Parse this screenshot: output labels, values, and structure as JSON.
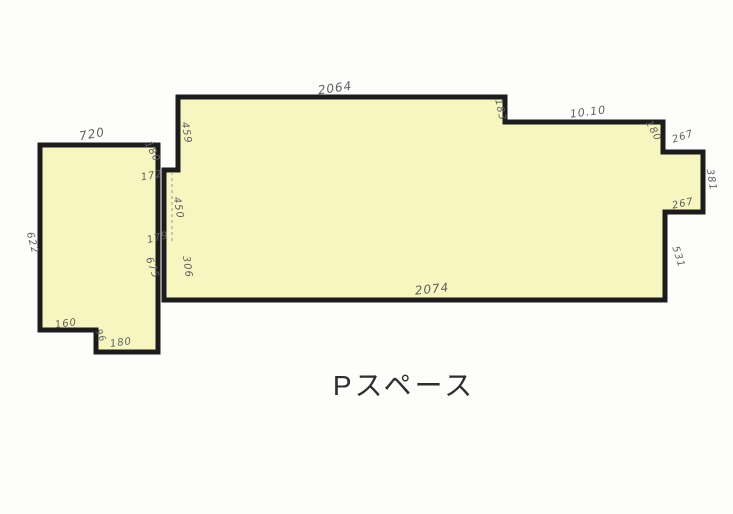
{
  "plan": {
    "title": "Pスペース",
    "fill_color": "#f7f6c1",
    "outline_color": "#1c1c1c",
    "label_color": "#5f5f5f",
    "dimension_labels": [
      {
        "text": "2064",
        "x": 335,
        "y": 88,
        "rot": -8,
        "size": 12
      },
      {
        "text": "183",
        "x": 500,
        "y": 110,
        "rot": 78,
        "size": 10
      },
      {
        "text": "10.10",
        "x": 588,
        "y": 112,
        "rot": -7,
        "size": 11
      },
      {
        "text": "180",
        "x": 653,
        "y": 131,
        "rot": 62,
        "size": 10
      },
      {
        "text": "267",
        "x": 683,
        "y": 137,
        "rot": -18,
        "size": 10
      },
      {
        "text": "381",
        "x": 711,
        "y": 180,
        "rot": 80,
        "size": 10
      },
      {
        "text": "267",
        "x": 683,
        "y": 204,
        "rot": -12,
        "size": 10
      },
      {
        "text": "531",
        "x": 678,
        "y": 257,
        "rot": 72,
        "size": 10
      },
      {
        "text": "2074",
        "x": 432,
        "y": 289,
        "rot": -6,
        "size": 12
      },
      {
        "text": "720",
        "x": 92,
        "y": 134,
        "rot": -10,
        "size": 12
      },
      {
        "text": "622",
        "x": 32,
        "y": 243,
        "rot": 75,
        "size": 10
      },
      {
        "text": "180",
        "x": 152,
        "y": 152,
        "rot": 62,
        "size": 10
      },
      {
        "text": "172",
        "x": 152,
        "y": 176,
        "rot": -10,
        "size": 10
      },
      {
        "text": "459",
        "x": 186,
        "y": 133,
        "rot": 80,
        "size": 10
      },
      {
        "text": "450",
        "x": 178,
        "y": 208,
        "rot": 80,
        "size": 10
      },
      {
        "text": "179",
        "x": 158,
        "y": 238,
        "rot": -14,
        "size": 10
      },
      {
        "text": "306",
        "x": 187,
        "y": 267,
        "rot": 82,
        "size": 10
      },
      {
        "text": "675",
        "x": 152,
        "y": 268,
        "rot": 70,
        "size": 10
      },
      {
        "text": "160",
        "x": 66,
        "y": 324,
        "rot": -8,
        "size": 10
      },
      {
        "text": "96",
        "x": 100,
        "y": 336,
        "rot": 65,
        "size": 9
      },
      {
        "text": "180",
        "x": 121,
        "y": 343,
        "rot": -8,
        "size": 10
      }
    ]
  }
}
